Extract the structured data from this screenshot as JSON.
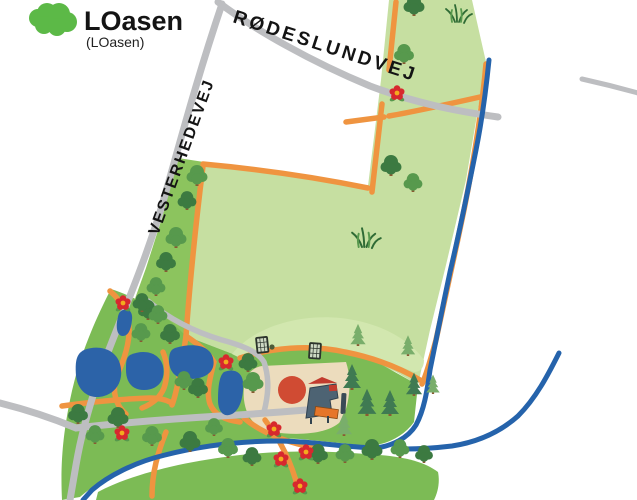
{
  "logo": {
    "title": "LOasen",
    "subtitle": "(LOasen)"
  },
  "map": {
    "road_labels": [
      {
        "name": "RØDESLUNDVEJ"
      },
      {
        "name": "VESTERHEDEVEJ"
      }
    ],
    "features": {
      "icons": [
        "tree-icon",
        "pine-tree-icon",
        "flower-icon",
        "football-goal-icon",
        "ball-icon",
        "grass-tuft-icon",
        "playground-structure-icon"
      ],
      "areas": [
        "meadow-field",
        "park-area",
        "hill-area",
        "river-bank",
        "playground-sand"
      ],
      "water": [
        "stream",
        "stream-branch",
        "ponds"
      ]
    }
  },
  "colors": {
    "field_green": "#c6dfa1",
    "hill_green": "#d2e7af",
    "park_green": "#7cbb55",
    "bank_green": "#7cbb55",
    "strip_green": "#8cc45e",
    "road_gray": "#bdbec1",
    "path_orange": "#ef9440",
    "stream_blue": "#2563ab",
    "pond_blue": "#2c63a8",
    "playground_sand": "#ecdcbd",
    "tree_dark": "#3c7a41",
    "tree_mid": "#57994d",
    "tree_light": "#6aa657",
    "trunk_brown": "#8a5a33",
    "pine_dark": "#3f7a52",
    "pine_light": "#79ae6b",
    "flower_red": "#d7282e",
    "flower_center": "#f3ac1e",
    "play_circle_red": "#d04b33",
    "structure_slate": "#4d6373",
    "structure_red": "#c23b2e",
    "slide_orange": "#e6762a",
    "goal_dark": "#2c342c",
    "grass_dark": "#2f6b35",
    "logo_green": "#5cb947",
    "label_black": "#141414"
  }
}
